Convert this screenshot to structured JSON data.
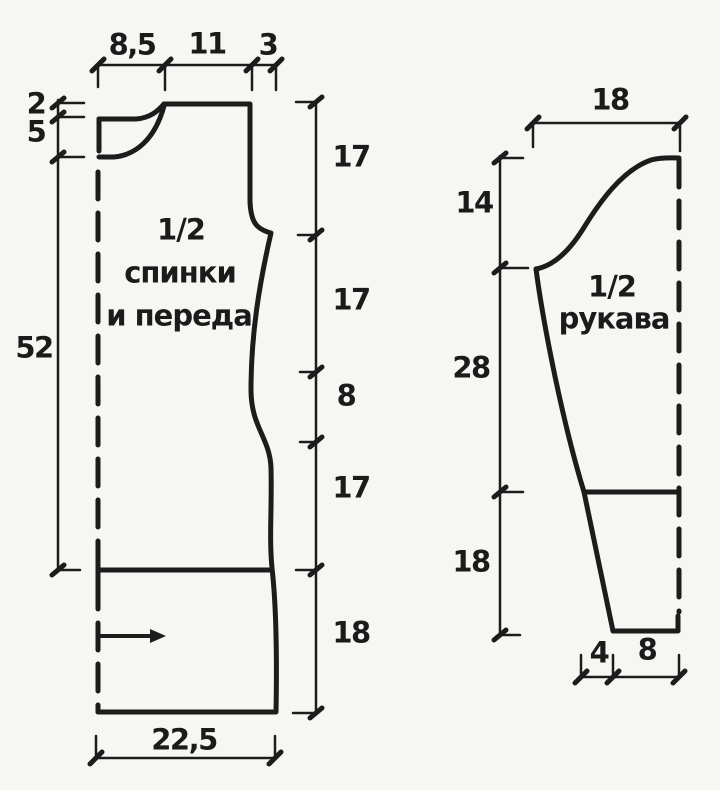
{
  "diagram_type": "garment-pattern-schematic",
  "colors": {
    "ink": "#1c1c1c",
    "paper": "#f6f6f3"
  },
  "body": {
    "title": [
      "1/2",
      "спинки",
      "и переда"
    ],
    "dims": {
      "top": [
        "8,5",
        "11",
        "3"
      ],
      "left": [
        "2",
        "5",
        "52"
      ],
      "right": [
        "17",
        "17",
        "8",
        "17",
        "18"
      ],
      "bottom": [
        "22,5"
      ]
    }
  },
  "sleeve": {
    "title": [
      "1/2",
      "рукава"
    ],
    "dims": {
      "top": [
        "18"
      ],
      "left": [
        "14",
        "28",
        "18"
      ],
      "bottom": [
        "4",
        "8"
      ]
    }
  }
}
